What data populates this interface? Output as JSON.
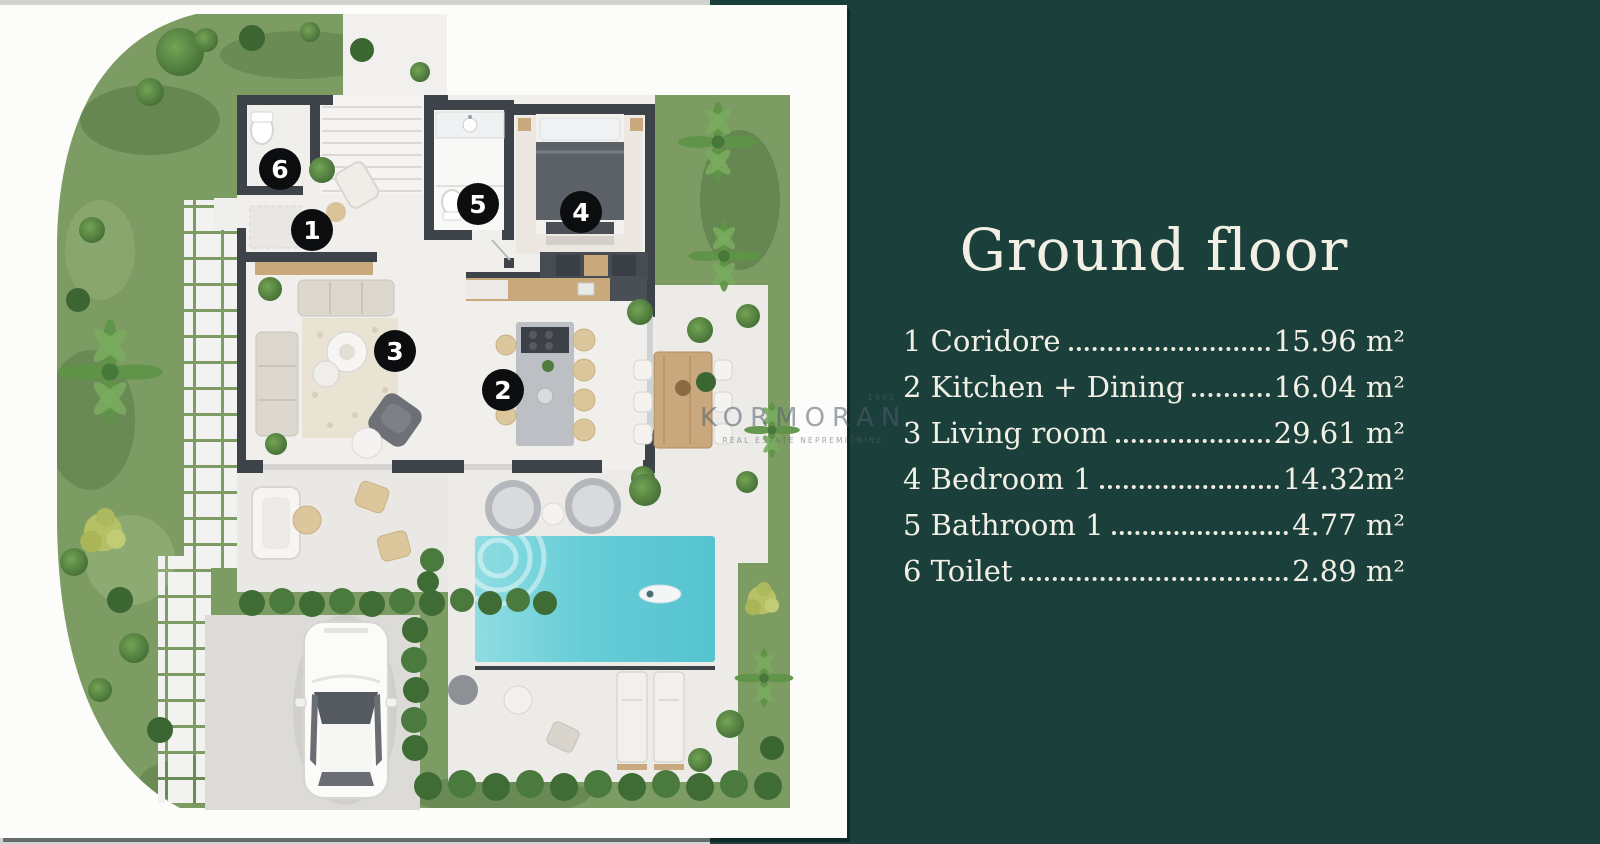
{
  "panel": {
    "title": "Ground floor",
    "legend": [
      {
        "num": "1",
        "label": "Coridore",
        "area": "15.96 m²"
      },
      {
        "num": "2",
        "label": "Kitchen + Dining",
        "area": "16.04 m²"
      },
      {
        "num": "3",
        "label": "Living room",
        "area": "29.61 m²"
      },
      {
        "num": "4",
        "label": "Bedroom 1",
        "area": "14.32m²"
      },
      {
        "num": "5",
        "label": "Bathroom 1",
        "area": "4.77 m²"
      },
      {
        "num": "6",
        "label": "Toilet",
        "area": "2.89 m²"
      }
    ]
  },
  "floor_plan": {
    "badges": [
      {
        "num": "1"
      },
      {
        "num": "2"
      },
      {
        "num": "3"
      },
      {
        "num": "4"
      },
      {
        "num": "5"
      },
      {
        "num": "6"
      }
    ]
  },
  "watermark": {
    "since": "1992",
    "brand": "KORMORAN",
    "tagline": "REAL ESTATE NEPREMIČNINE"
  },
  "colors": {
    "panel_green": "#1b403c",
    "wall": "#3e434a",
    "grass": "#7d9c63",
    "pool": "#5fc9d3",
    "text_cream": "#f2efe5"
  }
}
